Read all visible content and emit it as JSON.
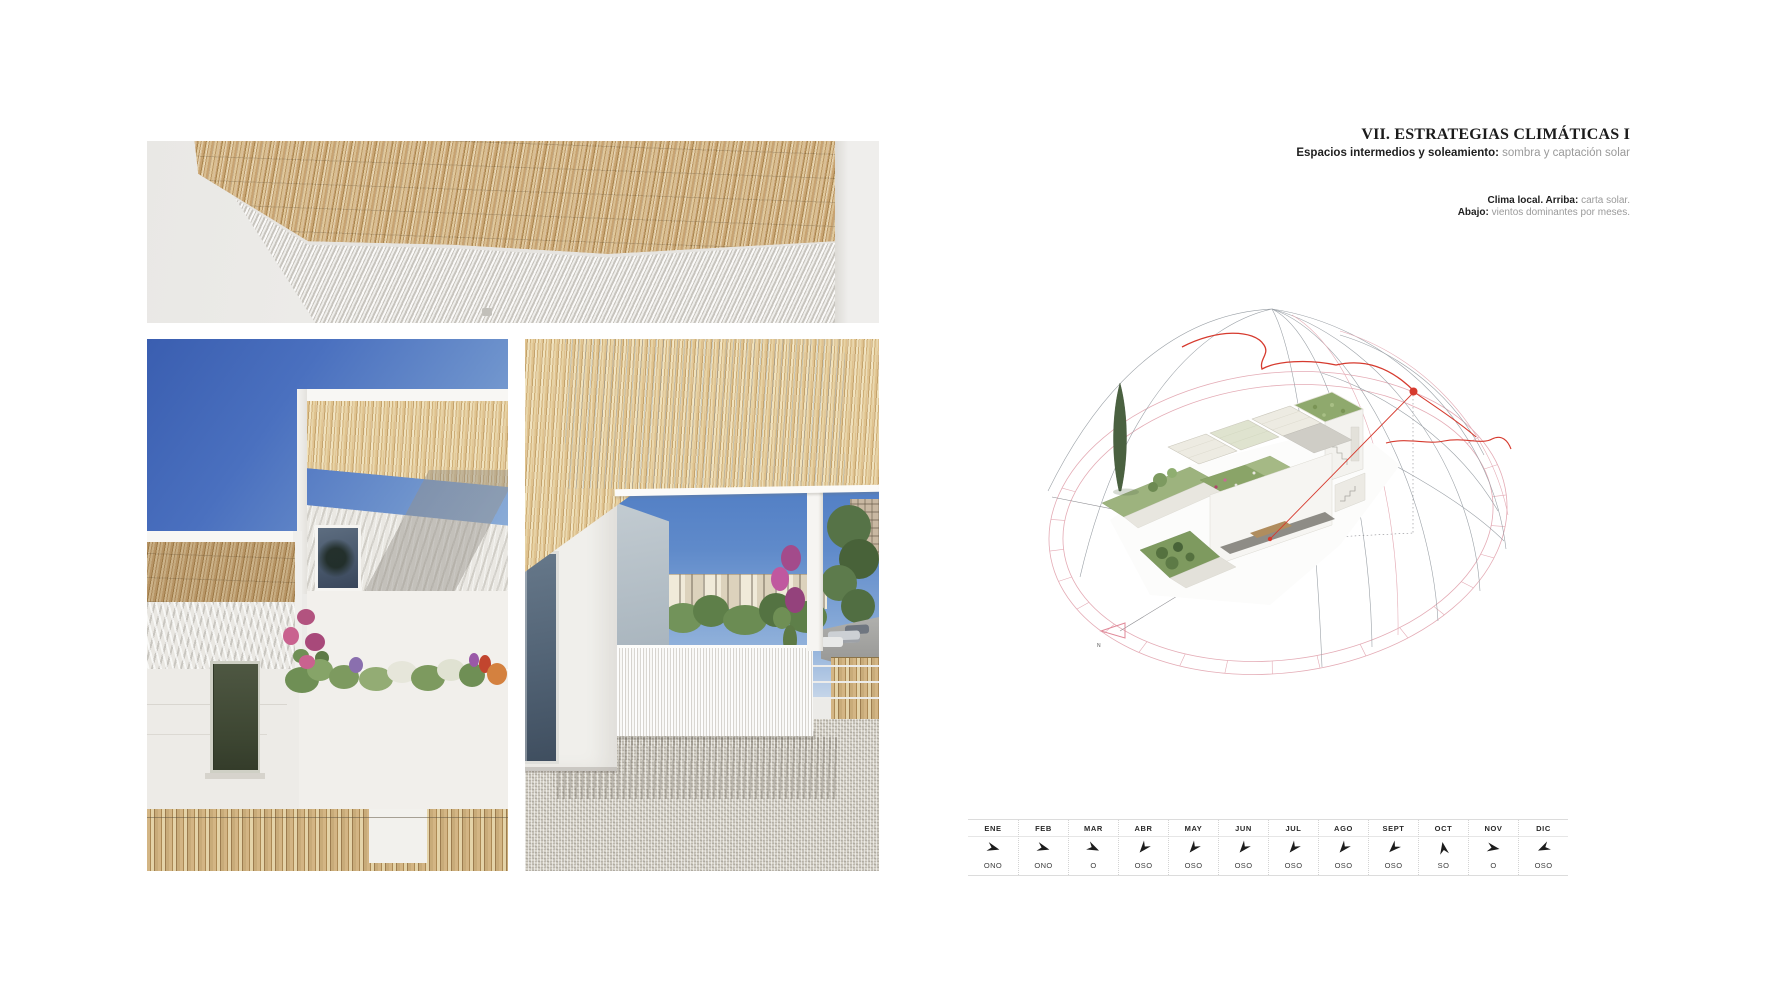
{
  "header": {
    "title": "VII. ESTRATEGIAS CLIMÁTICAS I",
    "subtitle_bold": "Espacios intermedios y soleamiento:",
    "subtitle_regular": " sombra y captación solar"
  },
  "caption": {
    "line1_bold": "Clima local. Arriba:",
    "line1_regular": " carta solar.",
    "line2_bold": "Abajo:",
    "line2_regular": " vientos dominantes por meses."
  },
  "solar_chart": {
    "type": "sun-path-dome",
    "north_label": "N",
    "accent_red": "#d63a2e",
    "ring_pink": "#e4abb5",
    "wire_gray": "#9aa0a6"
  },
  "chart_data": {
    "type": "table",
    "title": "vientos dominantes por meses",
    "columns": [
      "ENE",
      "FEB",
      "MAR",
      "ABR",
      "MAY",
      "JUN",
      "JUL",
      "AGO",
      "SEPT",
      "OCT",
      "NOV",
      "DIC"
    ],
    "rows": [
      [
        "ONO",
        "ONO",
        "O",
        "OSO",
        "OSO",
        "OSO",
        "OSO",
        "OSO",
        "OSO",
        "SO",
        "O",
        "OSO"
      ]
    ],
    "arrow_rotations_deg": [
      15,
      15,
      25,
      130,
      130,
      130,
      130,
      130,
      135,
      -100,
      10,
      155
    ]
  }
}
